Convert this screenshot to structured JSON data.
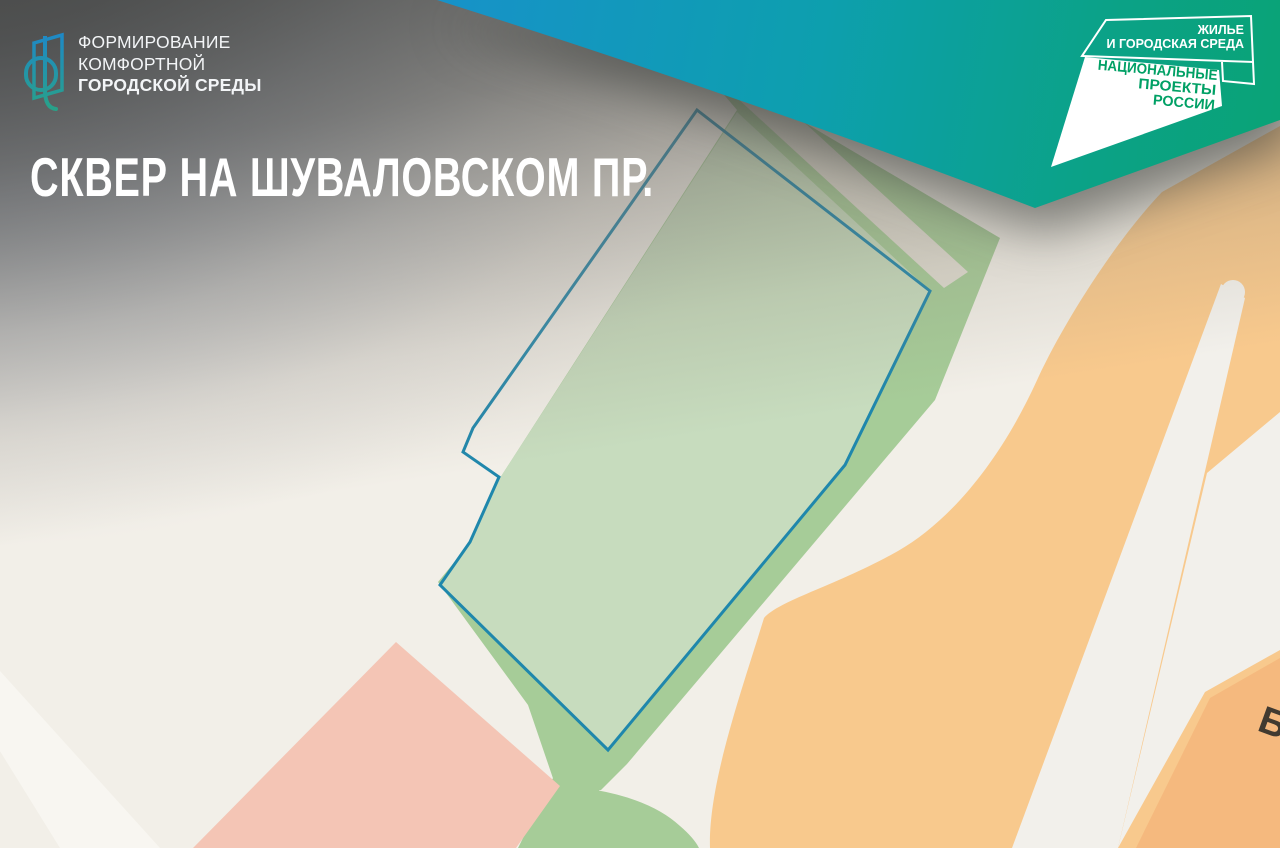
{
  "header": {
    "title": "СКВЕР НА ШУВАЛОВСКОМ ПР."
  },
  "fkgs_logo": {
    "line1": "ФОРМИРОВАНИЕ",
    "line2": "КОМФОРТНОЙ",
    "line3": "ГОРОДСКОЙ СРЕДЫ"
  },
  "np_logo": {
    "sector_line1": "ЖИЛЬЕ",
    "sector_line2": "И ГОРОДСКАЯ СРЕДА",
    "brand_line1": "НАЦИОНАЛЬНЫЕ",
    "brand_line2": "ПРОЕКТЫ",
    "brand_line3": "РОССИИ",
    "brand_green": "#00a065"
  },
  "banner": {
    "gradient_start": "#1792c9",
    "gradient_mid": "#0d9fae",
    "gradient_end": "#0aa376"
  },
  "map": {
    "street_label_partial": "Б",
    "colors": {
      "base": "#f2efe8",
      "site_fill": "#c7dcbe",
      "vegetation": "#a6cc98",
      "site_outline": "#1f87ac",
      "residential_pink": "#f4c5b5",
      "zone_orange": "#f8c98d",
      "building_orange": "#f5b97e",
      "road_white": "#f2f0eb",
      "road_gray": "#e0ddd2"
    }
  }
}
